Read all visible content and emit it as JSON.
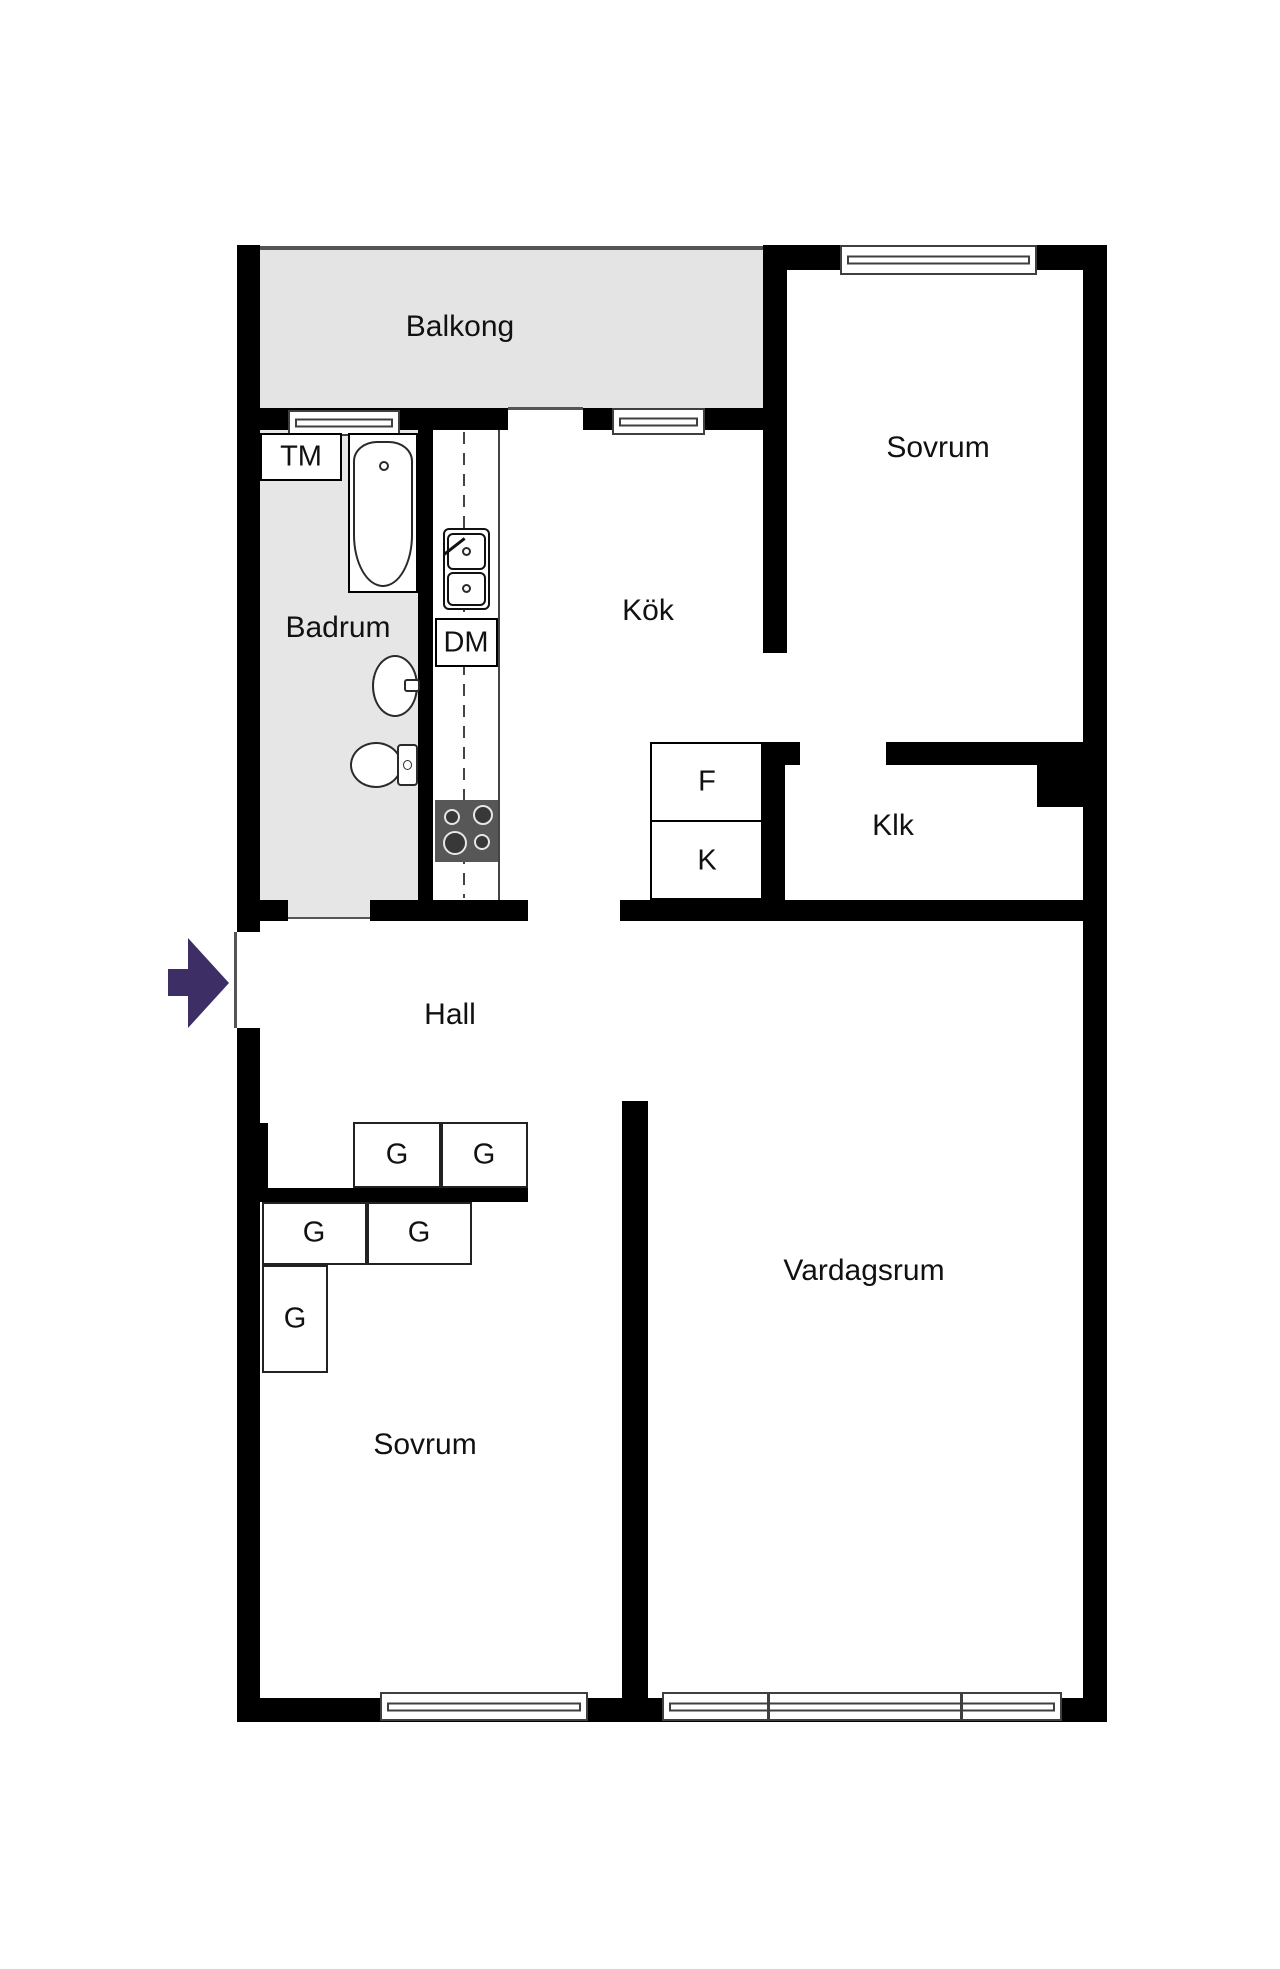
{
  "rooms": {
    "balcony": "Balkong",
    "bedroom_top": "Sovrum",
    "kitchen": "Kök",
    "bathroom": "Badrum",
    "closet": "Klk",
    "hall": "Hall",
    "living_room": "Vardagsrum",
    "bedroom_bottom": "Sovrum"
  },
  "fixtures": {
    "washing_machine": "TM",
    "dishwasher": "DM",
    "freezer": "F",
    "fridge": "K",
    "wardrobe": "G"
  },
  "colors": {
    "wall": "#000000",
    "floor_balcony": "#e4e4e4",
    "floor_bathroom": "#e6e6e6",
    "stove": "#575757",
    "entry_arrow": "#3d2f66",
    "line": "#3f3f3f",
    "threshold": "#555555"
  }
}
